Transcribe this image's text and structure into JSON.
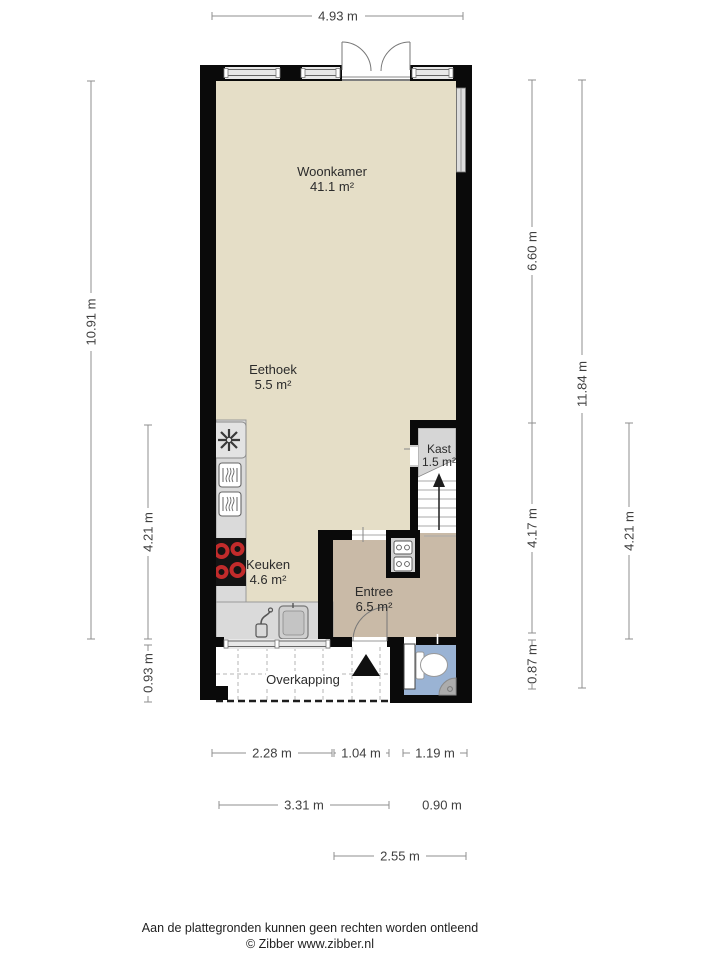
{
  "plan": {
    "rooms": {
      "woonkamer": {
        "name": "Woonkamer",
        "area": "41.1 m²"
      },
      "eethoek": {
        "name": "Eethoek",
        "area": "5.5 m²"
      },
      "keuken": {
        "name": "Keuken",
        "area": "4.6 m²"
      },
      "entree": {
        "name": "Entree",
        "area": "6.5 m²"
      },
      "kast": {
        "name": "Kast",
        "area": "1.5 m²"
      },
      "overkapping": {
        "name": "Overkapping"
      }
    },
    "dimensions": {
      "top_width": "4.93 m",
      "left_total": "10.91 m",
      "left_kitchen": "4.21 m",
      "left_overkapping": "0.93 m",
      "right_upper": "6.60 m",
      "right_lower": "4.17 m",
      "right_toilet": "0.87 m",
      "right_total": "11.84 m",
      "right_stairs": "4.21 m",
      "bottom_row1": [
        "2.28 m",
        "1.04 m",
        "1.19 m"
      ],
      "bottom_row2": [
        "3.31 m",
        "0.90 m"
      ],
      "bottom_row3": "2.55 m"
    },
    "icons": {
      "ventilation": "fan-icon",
      "appliances": "oven-icon",
      "cooktop": "cooktop-icon",
      "sink": "sink-icon",
      "faucet": "faucet-icon",
      "toilet": "toilet-icon",
      "corner_sink": "corner-sink-icon",
      "stairs_arrow": "stairs-up-arrow-icon",
      "entrance_arrow": "entrance-arrow-icon"
    },
    "colors": {
      "floor_main": "#e5dec7",
      "floor_entree": "#c9baa7",
      "floor_toilet": "#9ab3d4",
      "floor_kast": "#d6d6d6",
      "counter": "#dadada",
      "wall": "#0a0a0a",
      "burner": "#c22b2b"
    }
  },
  "footer": {
    "disclaimer": "Aan de plattegronden kunnen geen rechten worden ontleend",
    "credit": "© Zibber www.zibber.nl"
  }
}
